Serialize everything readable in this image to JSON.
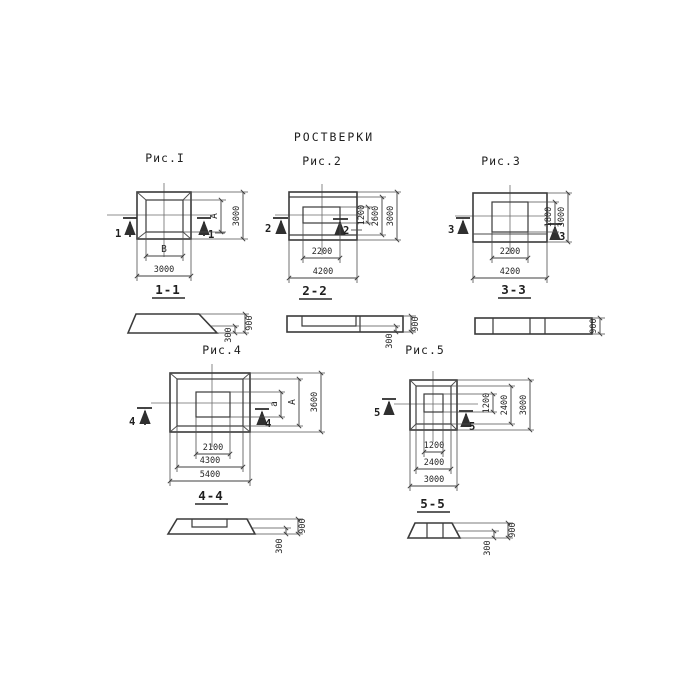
{
  "title": "РОСТВЕРКИ",
  "colors": {
    "ink": "#3a3a3a",
    "paper": "#ffffff"
  },
  "figures": [
    {
      "caption": "Рис.I",
      "mark": "1",
      "dims": {
        "inner_width": "В",
        "inner_height": "А",
        "outer_width": "3000",
        "outer_height": "3000"
      }
    },
    {
      "caption": "Рис.2",
      "mark": "2",
      "dims": {
        "inner_width": "2200",
        "outer_width": "4200",
        "inner_height": "1200",
        "mid_height": "2600",
        "outer_height": "3000"
      }
    },
    {
      "caption": "Рис.3",
      "mark": "3",
      "dims": {
        "inner_width": "2200",
        "outer_width": "4200",
        "inner_height": "1800",
        "outer_height": "3000"
      }
    },
    {
      "caption": "Рис.4",
      "mark": "4",
      "dims": {
        "inner_width": "2100",
        "mid_width": "4300",
        "outer_width": "5400",
        "inner_height": "а",
        "mid_height": "А",
        "outer_height": "3600"
      }
    },
    {
      "caption": "Рис.5",
      "mark": "5",
      "dims": {
        "inner_width": "1200",
        "mid_width": "2400",
        "outer_width": "3000",
        "inner_height": "1200",
        "mid_height": "2400",
        "outer_height": "3000"
      }
    }
  ],
  "sections": [
    {
      "label": "1-1",
      "step_height": "300",
      "total_height": "900"
    },
    {
      "label": "2-2",
      "step_height": "300",
      "total_height": "900"
    },
    {
      "label": "3-3",
      "total_height": "900"
    },
    {
      "label": "4-4",
      "step_height": "300",
      "total_height": "900"
    },
    {
      "label": "5-5",
      "step_height": "300",
      "total_height": "900"
    }
  ]
}
